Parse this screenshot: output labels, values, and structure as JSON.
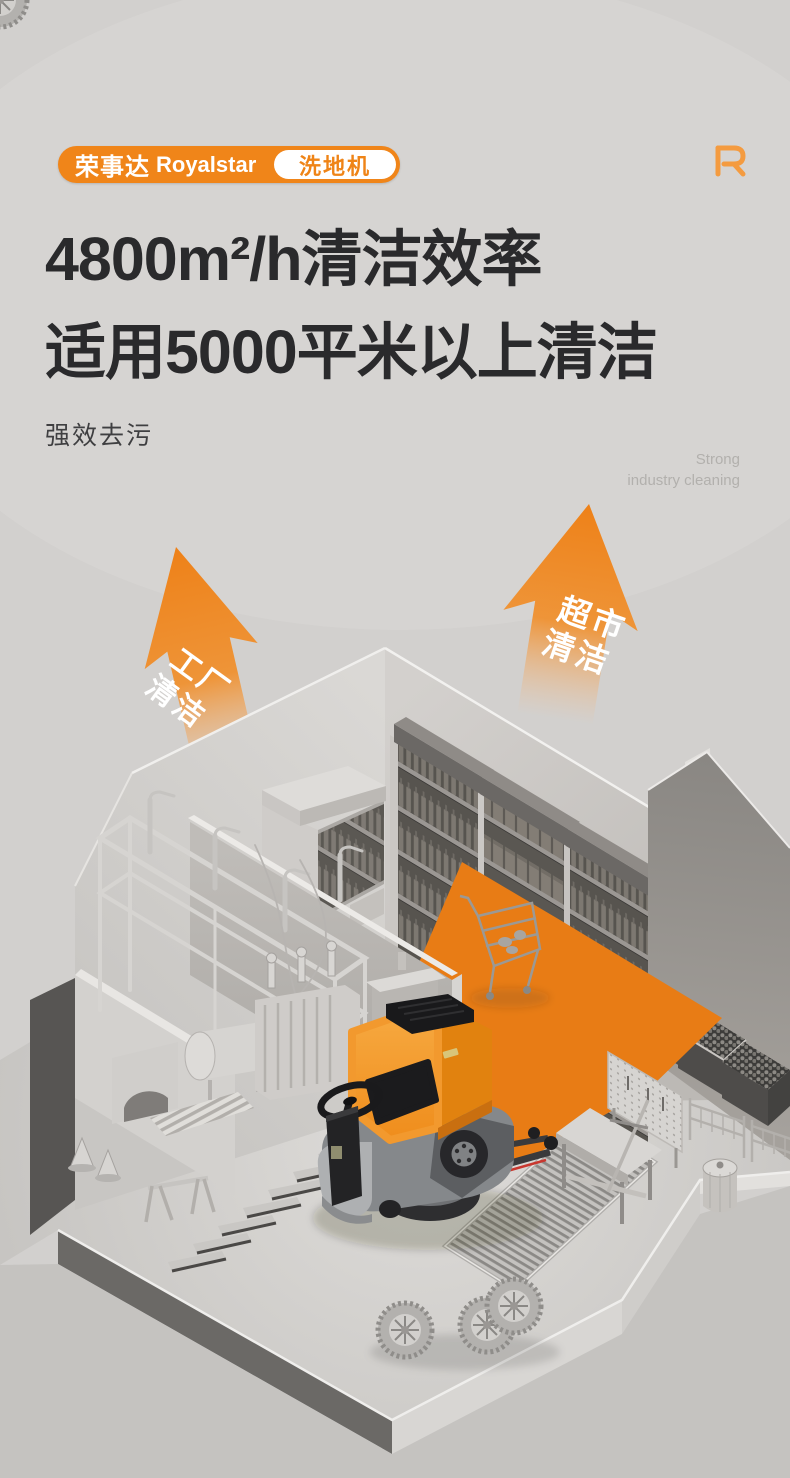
{
  "page": {
    "width": 790,
    "height": 1478,
    "background": "#d2d0ce"
  },
  "header": {
    "badge": {
      "brand_cn": "荣事达",
      "brand_en": "Royalstar",
      "tag_label": "洗地机",
      "badge_color": "#f08519",
      "tag_text_color": "#ef8417"
    },
    "corner_logo": "R",
    "headline_line1": "4800m²/h清洁效率",
    "headline_line2": "适用5000平米以上清洁",
    "subtitle_cn": "强效去污",
    "subtitle_en_line1": "Strong",
    "subtitle_en_line2": "industry cleaning"
  },
  "scene": {
    "arrow_left": {
      "line1": "工厂",
      "line2": "清洁"
    },
    "arrow_right": {
      "line1": "超市",
      "line2": "清洁"
    },
    "colors": {
      "arrow_orange": "#ee8118",
      "cleaned_path_orange": "#e87c15",
      "machine_body_orange": "#f2992e",
      "wall_gray": "#908d89",
      "concrete_gray": "#d2d0ce"
    }
  }
}
